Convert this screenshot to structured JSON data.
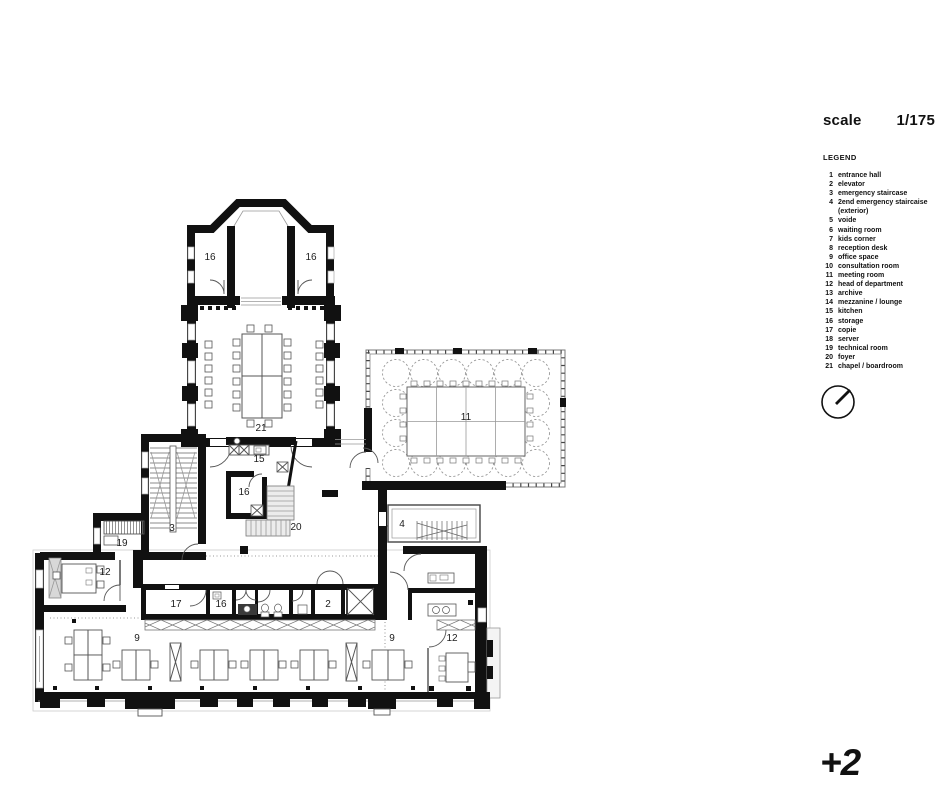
{
  "header": {
    "scale_label": "scale",
    "scale_value": "1/175"
  },
  "legend": {
    "title": "LEGEND",
    "items": [
      {
        "num": "1",
        "label": "entrance hall"
      },
      {
        "num": "2",
        "label": "elevator"
      },
      {
        "num": "3",
        "label": "emergency staircase"
      },
      {
        "num": "4",
        "label": "2end emergency staircaise (exterior)"
      },
      {
        "num": "5",
        "label": "voide"
      },
      {
        "num": "6",
        "label": "waiting room"
      },
      {
        "num": "7",
        "label": "kids corner"
      },
      {
        "num": "8",
        "label": "reception desk"
      },
      {
        "num": "9",
        "label": "office space"
      },
      {
        "num": "10",
        "label": "consultation room"
      },
      {
        "num": "11",
        "label": "meeting room"
      },
      {
        "num": "12",
        "label": "head of department"
      },
      {
        "num": "13",
        "label": "archive"
      },
      {
        "num": "14",
        "label": "mezzanine / lounge"
      },
      {
        "num": "15",
        "label": "kitchen"
      },
      {
        "num": "16",
        "label": "storage"
      },
      {
        "num": "17",
        "label": "copie"
      },
      {
        "num": "18",
        "label": "server"
      },
      {
        "num": "19",
        "label": "technical room"
      },
      {
        "num": "20",
        "label": "foyer"
      },
      {
        "num": "21",
        "label": "chapel / boardroom"
      }
    ]
  },
  "floor_indicator": "+2",
  "plan": {
    "labels": {
      "t16l": "16",
      "t16r": "16",
      "r21": "21",
      "r11": "11",
      "r15": "15",
      "s16": "16",
      "r20": "20",
      "r3": "3",
      "r19": "19",
      "r4": "4",
      "l12": "12",
      "r17": "17",
      "c16": "16",
      "r2": "2",
      "o9l": "9",
      "o9r": "9",
      "r12r": "12"
    },
    "colors": {
      "wall": "#111111",
      "thin_line": "#555555",
      "glass": "#999999",
      "paper": "#ffffff"
    }
  }
}
